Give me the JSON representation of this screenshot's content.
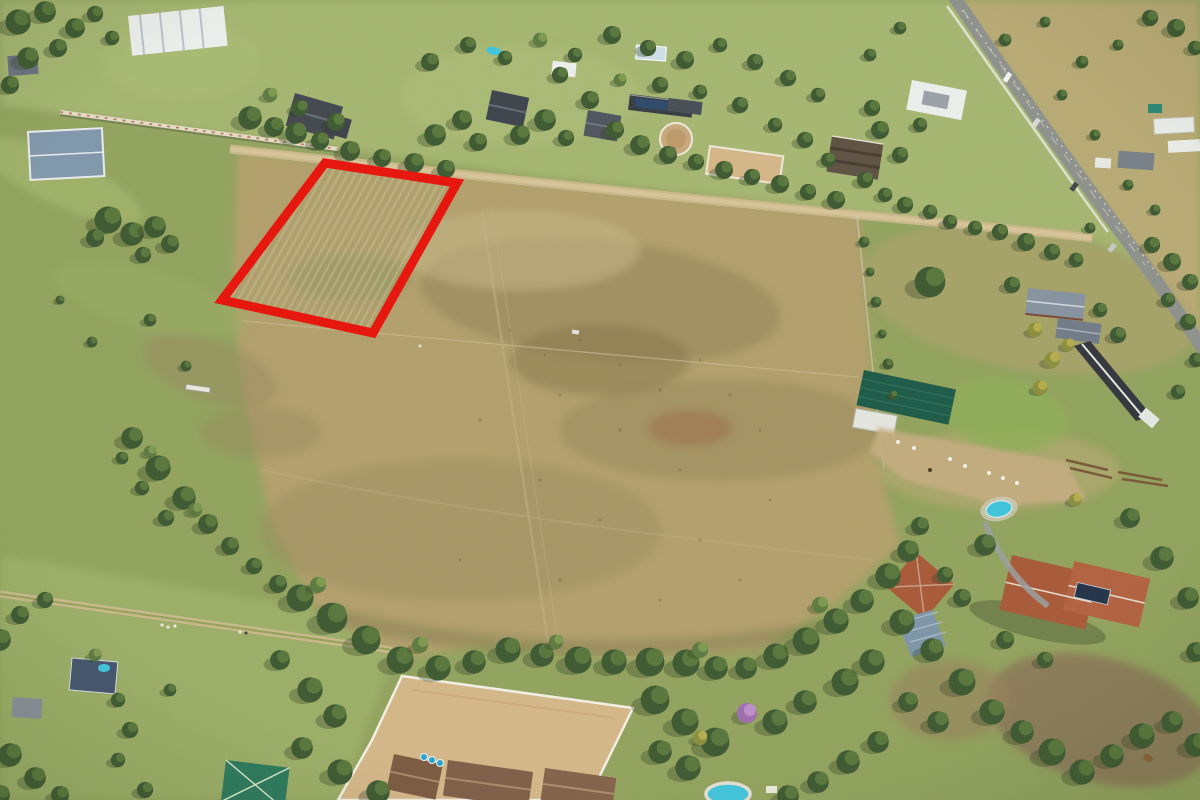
{
  "image": {
    "type": "aerial-drone-photograph",
    "subject": "Vacant rural land parcel marked with a red boundary overlay on a large smallholding among equestrian estates",
    "width_px": 1200,
    "height_px": 800,
    "text_content": "none"
  },
  "parcel_outline": {
    "shape": "quadrilateral",
    "points": "325,163 457,183 373,333 222,300",
    "color": "#e8140b",
    "stroke_width_px": 9,
    "interior": "mowed dry field with visible cut rows"
  },
  "palette": {
    "pasture_green": "#93a35e",
    "lawn_green": "#a6b671",
    "veld_tan": "#b9ab74",
    "dry_field_tan": "#b2a06c",
    "dry_field_dark": "#8f7f52",
    "sand_arena": "#d5b788",
    "dirt_road": "#cbb98c",
    "tar_road": "#8f928c",
    "tree_dark": "#3e5a31",
    "tree_mid": "#5b7a3e",
    "autumn_yellow": "#b5ad4c",
    "jacaranda_purple": "#a06cae",
    "roof_terracotta": "#a85a38",
    "roof_dark": "#44484f",
    "roof_white": "#edefec",
    "roof_green": "#2c7a5d",
    "roof_blue": "#45566e",
    "pool_blue": "#41c5dc",
    "shade_net_green": "#1e5b48",
    "parcel_red": "#e8140b"
  },
  "features": [
    {
      "name": "outlined-land-parcel",
      "desc": "red quadrilateral boundary over mowed field, upper left of the main holding"
    },
    {
      "name": "main-dry-field",
      "desc": "large tan fallow field occupying the centre of the frame with faint tracks and fence lines"
    },
    {
      "name": "top-estates",
      "desc": "band of wooded residential estates with dark-roofed mansions, lawns, stables and a small pool"
    },
    {
      "name": "boundary-wall",
      "desc": "white pillared wall running diagonally along upper-left field edge"
    },
    {
      "name": "top-dirt-road",
      "desc": "sand farm road between the estates and the field"
    },
    {
      "name": "tar-road",
      "desc": "paved road crossing the upper right corner diagonally with vehicles"
    },
    {
      "name": "top-right-veld",
      "desc": "open dry grassland with scattered trees and white warehouse sheds near right edge"
    },
    {
      "name": "lunging-ring",
      "desc": "circular sand horse ring in top estates"
    },
    {
      "name": "top-sand-arena",
      "desc": "rectangular sand arena beside the circular ring"
    },
    {
      "name": "left-pasture",
      "desc": "green grazing pasture with scattered trees and a small white horse jump"
    },
    {
      "name": "shade-net-structure",
      "desc": "dark green shade-net canopy on right-hand smallholding"
    },
    {
      "name": "animal-paddock",
      "desc": "sandy paddock with white sheep dots, right of the main field"
    },
    {
      "name": "mid-right-houses",
      "desc": "grey-roofed farmhouse cluster and long dark outbuilding with white ridge"
    },
    {
      "name": "terracotta-house-main",
      "desc": "large terracotta-roofed house with solar panels, kidney pool and driveway, lower right"
    },
    {
      "name": "terracotta-house-small",
      "desc": "smaller rotated terracotta-roofed house beside it"
    },
    {
      "name": "bottom-sand-arena",
      "desc": "large white-railed sand horse arena at bottom centre"
    },
    {
      "name": "lodge-buildings",
      "desc": "brown-roofed lodge buildings along the bottom edge with blue barrels"
    },
    {
      "name": "bottom-tree-line",
      "desc": "dense dark tree belt separating the field from the bottom properties"
    },
    {
      "name": "green-roof-house",
      "desc": "teal-green pyramid-roofed house at bottom left"
    },
    {
      "name": "blue-roof-house",
      "desc": "small dark-blue roofed house with plunge pool, lower left"
    },
    {
      "name": "left-dirt-track",
      "desc": "double-track dirt lane with figures, lower left"
    },
    {
      "name": "jacaranda-tree",
      "desc": "purple flowering tree above bottom-centre pool"
    },
    {
      "name": "round-pool-bottom",
      "desc": "turquoise pool partially visible at bottom edge"
    },
    {
      "name": "horse",
      "desc": "single brown horse in dirt paddock, bottom right corner"
    }
  ]
}
